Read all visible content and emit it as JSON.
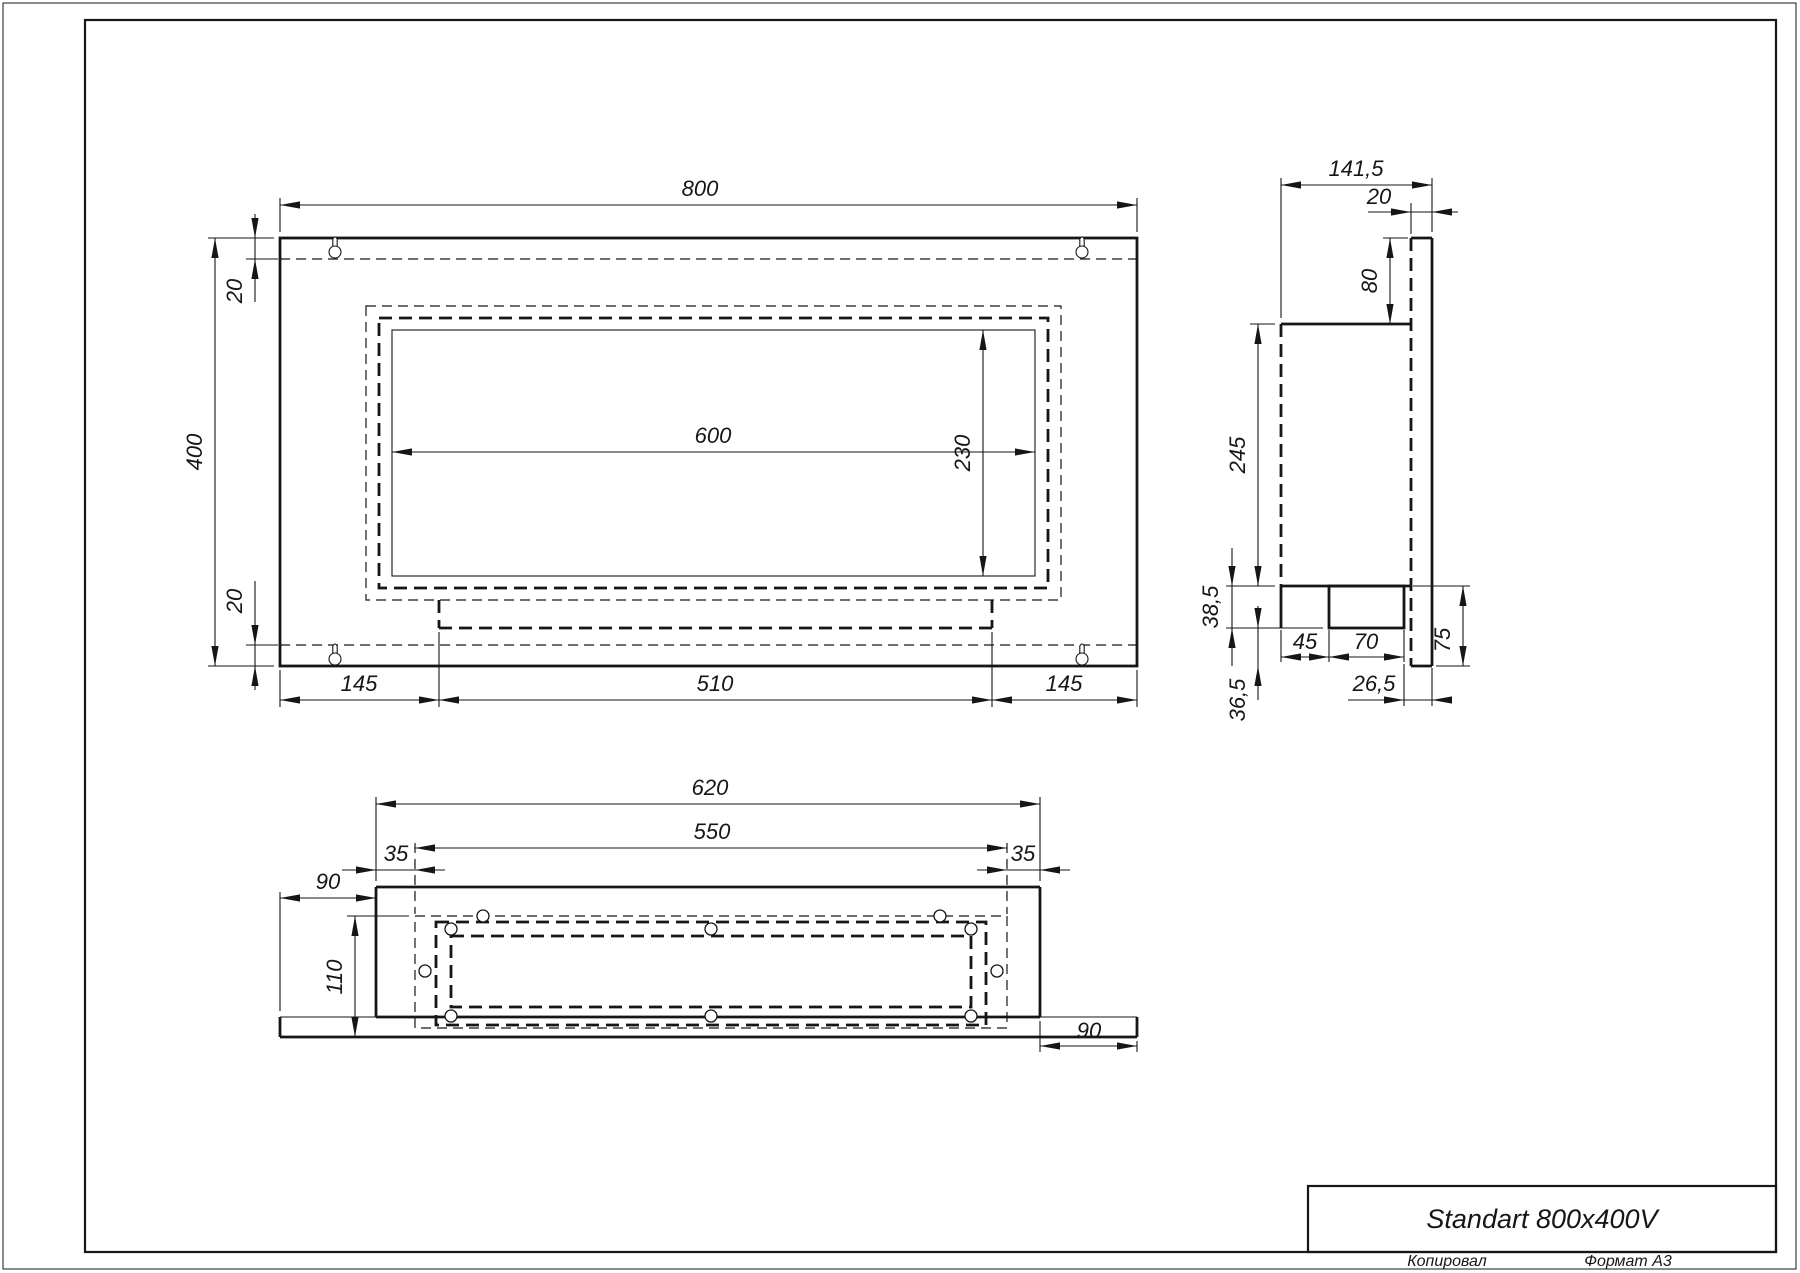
{
  "page": {
    "title_block": {
      "title": "Standart 800x400V"
    },
    "footer": {
      "copied_label": "Копировал",
      "format_label": "Формат А3"
    }
  },
  "views": {
    "front_view": {
      "label": "front view",
      "dimensions": [
        "800",
        "400",
        "20",
        "20",
        "600",
        "230",
        "145",
        "510",
        "145"
      ]
    },
    "side_view": {
      "label": "side view",
      "dimensions": [
        "141,5",
        "20",
        "80",
        "245",
        "38,5",
        "36,5",
        "45",
        "70",
        "26,5",
        "75"
      ]
    },
    "bottom_view": {
      "label": "bottom view",
      "dimensions": [
        "620",
        "550",
        "35",
        "35",
        "90",
        "110",
        "90"
      ]
    }
  },
  "drawing": {
    "canvas": {
      "w": 1800,
      "h": 1273
    },
    "ink": "#161616",
    "frame": {
      "outer": [
        3,
        3,
        1793,
        1266
      ],
      "inner": [
        85,
        20,
        1691,
        1232
      ],
      "title_box": [
        1308,
        1186,
        468,
        66
      ]
    },
    "rects_solid_thick": [
      [
        280,
        238,
        857,
        428
      ],
      [
        1329,
        586,
        75,
        42
      ]
    ],
    "rects_solid_thin": [
      [
        392,
        330,
        643,
        246
      ]
    ],
    "rects_dashed_thick": [
      [
        379,
        318,
        669,
        270
      ],
      [
        436,
        922,
        550,
        103
      ],
      [
        451,
        936,
        520,
        71
      ]
    ],
    "rects_dashed_thin": [
      [
        366,
        306,
        695,
        294
      ],
      [
        415,
        916,
        592,
        112
      ]
    ],
    "solid_thick_lines": [
      [
        1411,
        238,
        1432,
        238
      ],
      [
        1432,
        238,
        1432,
        666
      ],
      [
        1411,
        666,
        1432,
        666
      ],
      [
        1281,
        324,
        1411,
        324
      ],
      [
        1281,
        586,
        1411,
        586
      ],
      [
        1281,
        586,
        1281,
        628
      ],
      [
        376,
        887,
        1040,
        887
      ],
      [
        376,
        887,
        376,
        1017
      ],
      [
        1040,
        887,
        1040,
        1017
      ],
      [
        280,
        1037,
        1137,
        1037
      ],
      [
        280,
        1017,
        280,
        1037
      ],
      [
        1137,
        1017,
        1137,
        1037
      ],
      [
        376,
        1017,
        1040,
        1017
      ]
    ],
    "solid_thin_lines": [
      [
        280,
        1017,
        376,
        1017
      ],
      [
        1040,
        1017,
        1137,
        1017
      ]
    ],
    "dashed_thick_lines": [
      [
        1411,
        238,
        1411,
        666
      ],
      [
        1281,
        324,
        1281,
        586
      ],
      [
        439,
        600,
        439,
        628
      ],
      [
        992,
        600,
        992,
        628
      ],
      [
        439,
        628,
        992,
        628
      ]
    ],
    "dashed_thin_lines": [
      [
        280,
        259,
        1137,
        259
      ],
      [
        280,
        645,
        1137,
        645
      ],
      [
        415,
        843,
        415,
        914
      ],
      [
        1007,
        843,
        1007,
        914
      ]
    ],
    "extension_lines": [
      [
        280,
        232,
        280,
        198
      ],
      [
        1137,
        232,
        1137,
        198
      ],
      [
        274,
        238,
        208,
        238
      ],
      [
        274,
        666,
        208,
        666
      ],
      [
        278,
        259,
        246,
        259
      ],
      [
        278,
        645,
        246,
        645
      ],
      [
        280,
        670,
        280,
        707
      ],
      [
        439,
        632,
        439,
        707
      ],
      [
        992,
        632,
        992,
        707
      ],
      [
        1137,
        670,
        1137,
        707
      ],
      [
        1281,
        318,
        1281,
        178
      ],
      [
        1432,
        232,
        1432,
        178
      ],
      [
        1411,
        234,
        1411,
        203
      ],
      [
        1408,
        238,
        1383,
        238
      ],
      [
        1275,
        324,
        1250,
        324
      ],
      [
        1275,
        586,
        1226,
        586
      ],
      [
        1323,
        628,
        1226,
        628
      ],
      [
        1281,
        630,
        1281,
        662
      ],
      [
        1329,
        630,
        1329,
        662
      ],
      [
        1404,
        630,
        1404,
        662
      ],
      [
        1404,
        664,
        1404,
        706
      ],
      [
        1432,
        668,
        1432,
        706
      ],
      [
        1413,
        586,
        1470,
        586
      ],
      [
        1436,
        666,
        1470,
        666
      ],
      [
        376,
        881,
        376,
        797
      ],
      [
        1040,
        881,
        1040,
        797
      ],
      [
        280,
        1011,
        280,
        892
      ],
      [
        409,
        916,
        347,
        916
      ],
      [
        1040,
        1021,
        1040,
        1052
      ],
      [
        1137,
        1041,
        1137,
        1052
      ]
    ],
    "dimension_lines": [
      [
        280,
        205,
        1137,
        205
      ],
      [
        215,
        238,
        215,
        666
      ],
      [
        255,
        214,
        255,
        302
      ],
      [
        255,
        581,
        255,
        690
      ],
      [
        392,
        452,
        1035,
        452
      ],
      [
        983,
        330,
        983,
        576
      ],
      [
        280,
        700,
        1137,
        700
      ],
      [
        1281,
        185,
        1432,
        185
      ],
      [
        1368,
        212,
        1458,
        212
      ],
      [
        1390,
        238,
        1390,
        324
      ],
      [
        1258,
        324,
        1258,
        586
      ],
      [
        1232,
        548,
        1232,
        666
      ],
      [
        1258,
        606,
        1258,
        700
      ],
      [
        1281,
        657,
        1404,
        657
      ],
      [
        1348,
        700,
        1448,
        700
      ],
      [
        1463,
        586,
        1463,
        666
      ],
      [
        376,
        804,
        1040,
        804
      ],
      [
        415,
        848,
        1007,
        848
      ],
      [
        342,
        870,
        445,
        870
      ],
      [
        977,
        870,
        1070,
        870
      ],
      [
        280,
        898,
        376,
        898
      ],
      [
        355,
        916,
        355,
        1037
      ],
      [
        1040,
        1046,
        1137,
        1046
      ]
    ],
    "arrows": [
      [
        280,
        205,
        "L"
      ],
      [
        1137,
        205,
        "R"
      ],
      [
        215,
        238,
        "U"
      ],
      [
        215,
        666,
        "D"
      ],
      [
        255,
        238,
        "D"
      ],
      [
        255,
        259,
        "U"
      ],
      [
        255,
        645,
        "D"
      ],
      [
        255,
        666,
        "U"
      ],
      [
        392,
        452,
        "L"
      ],
      [
        1035,
        452,
        "R"
      ],
      [
        983,
        330,
        "U"
      ],
      [
        983,
        576,
        "D"
      ],
      [
        280,
        700,
        "L"
      ],
      [
        439,
        700,
        "R"
      ],
      [
        439,
        700,
        "L"
      ],
      [
        992,
        700,
        "R"
      ],
      [
        992,
        700,
        "L"
      ],
      [
        1137,
        700,
        "R"
      ],
      [
        1281,
        185,
        "L"
      ],
      [
        1432,
        185,
        "R"
      ],
      [
        1411,
        212,
        "R"
      ],
      [
        1432,
        212,
        "L"
      ],
      [
        1390,
        238,
        "U"
      ],
      [
        1390,
        324,
        "D"
      ],
      [
        1258,
        324,
        "U"
      ],
      [
        1258,
        586,
        "D"
      ],
      [
        1232,
        586,
        "D"
      ],
      [
        1232,
        628,
        "U"
      ],
      [
        1258,
        628,
        "D"
      ],
      [
        1258,
        666,
        "U"
      ],
      [
        1281,
        657,
        "L"
      ],
      [
        1329,
        657,
        "R"
      ],
      [
        1329,
        657,
        "L"
      ],
      [
        1404,
        657,
        "R"
      ],
      [
        1404,
        700,
        "R"
      ],
      [
        1432,
        700,
        "L"
      ],
      [
        1463,
        586,
        "U"
      ],
      [
        1463,
        666,
        "D"
      ],
      [
        376,
        804,
        "L"
      ],
      [
        1040,
        804,
        "R"
      ],
      [
        415,
        848,
        "L"
      ],
      [
        1007,
        848,
        "R"
      ],
      [
        376,
        870,
        "R"
      ],
      [
        415,
        870,
        "L"
      ],
      [
        1007,
        870,
        "R"
      ],
      [
        1040,
        870,
        "L"
      ],
      [
        280,
        898,
        "L"
      ],
      [
        376,
        898,
        "R"
      ],
      [
        355,
        916,
        "U"
      ],
      [
        355,
        1037,
        "D"
      ],
      [
        1040,
        1046,
        "L"
      ],
      [
        1137,
        1046,
        "R"
      ]
    ],
    "labels": [
      {
        "t": "800",
        "x": 700,
        "y": 196,
        "r": 0
      },
      {
        "t": "400",
        "x": 202,
        "y": 452,
        "r": -90
      },
      {
        "t": "20",
        "x": 242,
        "y": 291,
        "r": -90
      },
      {
        "t": "20",
        "x": 242,
        "y": 601,
        "r": -90
      },
      {
        "t": "600",
        "x": 713,
        "y": 443,
        "r": 0
      },
      {
        "t": "230",
        "x": 970,
        "y": 453,
        "r": -90
      },
      {
        "t": "145",
        "x": 359,
        "y": 691,
        "r": 0
      },
      {
        "t": "510",
        "x": 715,
        "y": 691,
        "r": 0
      },
      {
        "t": "145",
        "x": 1064,
        "y": 691,
        "r": 0
      },
      {
        "t": "141,5",
        "x": 1356,
        "y": 176,
        "r": 0
      },
      {
        "t": "20",
        "x": 1379,
        "y": 204,
        "r": 0
      },
      {
        "t": "80",
        "x": 1377,
        "y": 281,
        "r": -90
      },
      {
        "t": "245",
        "x": 1245,
        "y": 455,
        "r": -90
      },
      {
        "t": "38,5",
        "x": 1218,
        "y": 607,
        "r": -90
      },
      {
        "t": "36,5",
        "x": 1245,
        "y": 700,
        "r": -90
      },
      {
        "t": "45",
        "x": 1305,
        "y": 649,
        "r": 0
      },
      {
        "t": "70",
        "x": 1366,
        "y": 649,
        "r": 0
      },
      {
        "t": "26,5",
        "x": 1374,
        "y": 691,
        "r": 0
      },
      {
        "t": "75",
        "x": 1450,
        "y": 640,
        "r": -90
      },
      {
        "t": "620",
        "x": 710,
        "y": 795,
        "r": 0
      },
      {
        "t": "550",
        "x": 712,
        "y": 839,
        "r": 0
      },
      {
        "t": "35",
        "x": 396,
        "y": 861,
        "r": 0
      },
      {
        "t": "35",
        "x": 1023,
        "y": 861,
        "r": 0
      },
      {
        "t": "90",
        "x": 328,
        "y": 889,
        "r": 0
      },
      {
        "t": "110",
        "x": 342,
        "y": 977,
        "r": -90
      },
      {
        "t": "90",
        "x": 1089,
        "y": 1038,
        "r": 0
      }
    ],
    "keyholes": [
      [
        335,
        252
      ],
      [
        1082,
        252
      ],
      [
        335,
        659
      ],
      [
        1082,
        659
      ]
    ],
    "holes": [
      [
        483,
        916
      ],
      [
        940,
        916
      ],
      [
        451,
        929
      ],
      [
        711,
        929
      ],
      [
        971,
        929
      ],
      [
        425,
        971
      ],
      [
        997,
        971
      ],
      [
        451,
        1016
      ],
      [
        711,
        1016
      ],
      [
        971,
        1016
      ]
    ]
  }
}
